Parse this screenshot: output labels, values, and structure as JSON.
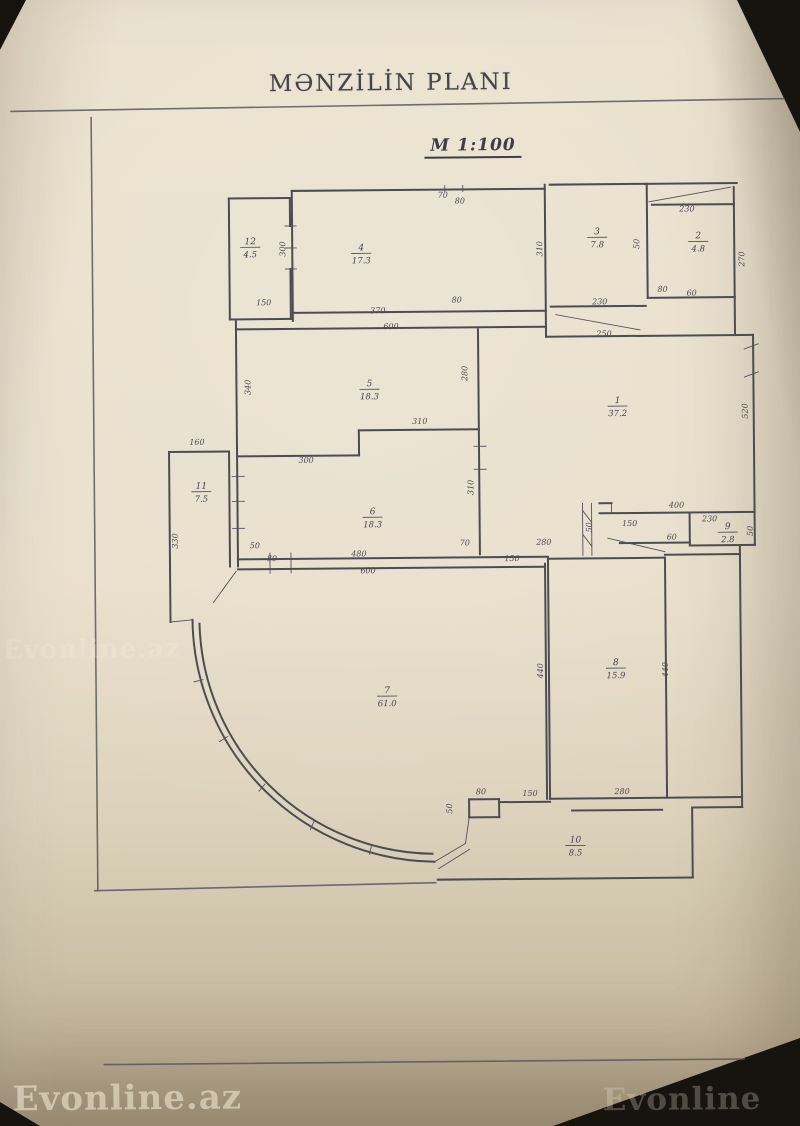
{
  "title": "MƏNZİLİN PLANI",
  "scale_label": "M 1:100",
  "watermarks": {
    "bottom_left": "Evonline.az",
    "bottom_right": "Evonline",
    "mid_left": "Evonline.az"
  },
  "colors": {
    "paper": "#e8dfca",
    "ink": "#4e4b55",
    "frame": "#5b5660",
    "background": "#171410"
  },
  "plan": {
    "frame": [
      "M15,108 L788,102",
      "M95,115 V888",
      "M92,888 L433,883",
      "M100,1062 H740"
    ],
    "walls_heavy": [
      "M232,197 H293",
      "M232,197 V318",
      "M232,318 H293",
      "M293,197 V225",
      "M293,268 V318",
      "M295,190 H548",
      "M295,190 V320",
      "M548,186 V338",
      "M553,186 H648",
      "M648,186 H740",
      "M650,186 V300",
      "M737,190 V300",
      "M650,300 H737",
      "M737,300 V338",
      "M553,308 H648",
      "M548,338 H755",
      "M755,338 V548",
      "M295,312 H548",
      "M238,328 H548",
      "M238,320 V565",
      "M480,330 V555",
      "M240,455 H360",
      "M360,430 V455",
      "M360,430 H480",
      "M238,558 H548",
      "M238,568 H545",
      "M600,505 H612",
      "M600,515 H755",
      "M690,515 V548",
      "M690,548 H755",
      "M620,545 H690",
      "M548,560 H665",
      "M665,557 H740",
      "M545,565 V800",
      "M548,560 V800",
      "M665,560 V800",
      "M740,548 V800",
      "M548,800 H740",
      "M570,812 H660",
      "M467,800 H497",
      "M467,800 V818",
      "M497,800 V818",
      "M467,818 H497",
      "M497,803 H548",
      "M435,880 H690",
      "M690,812 V880",
      "M740,800 V810",
      "M690,810 H740",
      "M192,618 A245,245 0 0 0 432,862",
      "M199,622 A236,236 0 0 0 430,854",
      "M170,450 H230",
      "M170,450 V620",
      "M230,450 V565",
      "M655,207 H737"
    ],
    "walls_light": [
      "M288,225 H299",
      "M288,247 H299",
      "M288,268 H299",
      "M652,204 L734,190",
      "M558,316 L642,332",
      "M746,352 L760,347",
      "M746,380 L760,375",
      "M233,475 H245",
      "M233,500 H245",
      "M233,527 H245",
      "M475,447 H487",
      "M475,470 H487",
      "M270,552 V572",
      "M291,552 V572",
      "M612,505 V515",
      "M608,540 L665,554",
      "M193,680 L202,678",
      "M218,740 L226,735",
      "M257,790 L263,783",
      "M308,829 L312,820",
      "M367,854 L369,845",
      "M432,862 L463,844",
      "M436,869 L467,850",
      "M463,844 L467,818",
      "M170,620 L192,618",
      "M213,601 L236,570",
      "M583,505 V557",
      "M592,505 V557",
      "M583,512 L592,524",
      "M583,536 L592,548",
      "M448,186 V192",
      "M466,186 V192"
    ],
    "dims": [
      {
        "t": "70",
        "x": 446,
        "y": 198
      },
      {
        "t": "80",
        "x": 463,
        "y": 204
      },
      {
        "t": "230",
        "x": 690,
        "y": 214
      },
      {
        "t": "310",
        "x": 545,
        "y": 250,
        "r": 1
      },
      {
        "t": "150",
        "x": 266,
        "y": 304
      },
      {
        "t": "300",
        "x": 288,
        "y": 248,
        "r": 1
      },
      {
        "t": "50",
        "x": 642,
        "y": 246,
        "r": 1
      },
      {
        "t": "270",
        "x": 747,
        "y": 262,
        "r": 1
      },
      {
        "t": "80",
        "x": 665,
        "y": 294
      },
      {
        "t": "60",
        "x": 694,
        "y": 298
      },
      {
        "t": "230",
        "x": 602,
        "y": 306
      },
      {
        "t": "250",
        "x": 606,
        "y": 338
      },
      {
        "t": "370",
        "x": 380,
        "y": 313
      },
      {
        "t": "80",
        "x": 459,
        "y": 303
      },
      {
        "t": "600",
        "x": 393,
        "y": 329
      },
      {
        "t": "340",
        "x": 252,
        "y": 386,
        "r": 1
      },
      {
        "t": "280",
        "x": 469,
        "y": 374,
        "r": 1
      },
      {
        "t": "310",
        "x": 421,
        "y": 424
      },
      {
        "t": "310",
        "x": 474,
        "y": 488,
        "r": 1
      },
      {
        "t": "300",
        "x": 307,
        "y": 462
      },
      {
        "t": "160",
        "x": 198,
        "y": 443
      },
      {
        "t": "330",
        "x": 178,
        "y": 539,
        "r": 1
      },
      {
        "t": "520",
        "x": 749,
        "y": 414,
        "r": 1
      },
      {
        "t": "400",
        "x": 677,
        "y": 510
      },
      {
        "t": "150",
        "x": 630,
        "y": 528
      },
      {
        "t": "230",
        "x": 710,
        "y": 524
      },
      {
        "t": "60",
        "x": 672,
        "y": 542
      },
      {
        "t": "50",
        "x": 592,
        "y": 529,
        "r": 1
      },
      {
        "t": "50",
        "x": 753,
        "y": 534,
        "r": 1
      },
      {
        "t": "280",
        "x": 544,
        "y": 546
      },
      {
        "t": "70",
        "x": 465,
        "y": 546
      },
      {
        "t": "150",
        "x": 512,
        "y": 562
      },
      {
        "t": "50",
        "x": 255,
        "y": 547
      },
      {
        "t": "80",
        "x": 272,
        "y": 560
      },
      {
        "t": "480",
        "x": 359,
        "y": 556
      },
      {
        "t": "600",
        "x": 368,
        "y": 573
      },
      {
        "t": "440",
        "x": 542,
        "y": 672,
        "r": 1
      },
      {
        "t": "440",
        "x": 667,
        "y": 672,
        "r": 1
      },
      {
        "t": "50",
        "x": 450,
        "y": 809,
        "r": 1
      },
      {
        "t": "80",
        "x": 479,
        "y": 795
      },
      {
        "t": "150",
        "x": 528,
        "y": 797
      },
      {
        "t": "280",
        "x": 620,
        "y": 796
      }
    ],
    "rooms": [
      {
        "no": "12",
        "area": "4.5",
        "x": 253,
        "y": 247
      },
      {
        "no": "4",
        "area": "17.3",
        "x": 364,
        "y": 254
      },
      {
        "no": "3",
        "area": "7.8",
        "x": 600,
        "y": 240
      },
      {
        "no": "2",
        "area": "4.8",
        "x": 701,
        "y": 245
      },
      {
        "no": "5",
        "area": "18.3",
        "x": 371,
        "y": 390
      },
      {
        "no": "1",
        "area": "37.2",
        "x": 619,
        "y": 409
      },
      {
        "no": "11",
        "area": "7.5",
        "x": 202,
        "y": 491
      },
      {
        "no": "6",
        "area": "18.3",
        "x": 373,
        "y": 518
      },
      {
        "no": "9",
        "area": "2.8",
        "x": 728,
        "y": 536
      },
      {
        "no": "7",
        "area": "61.0",
        "x": 386,
        "y": 697
      },
      {
        "no": "8",
        "area": "15.9",
        "x": 615,
        "y": 671
      },
      {
        "no": "10",
        "area": "8.5",
        "x": 573,
        "y": 848
      }
    ]
  }
}
